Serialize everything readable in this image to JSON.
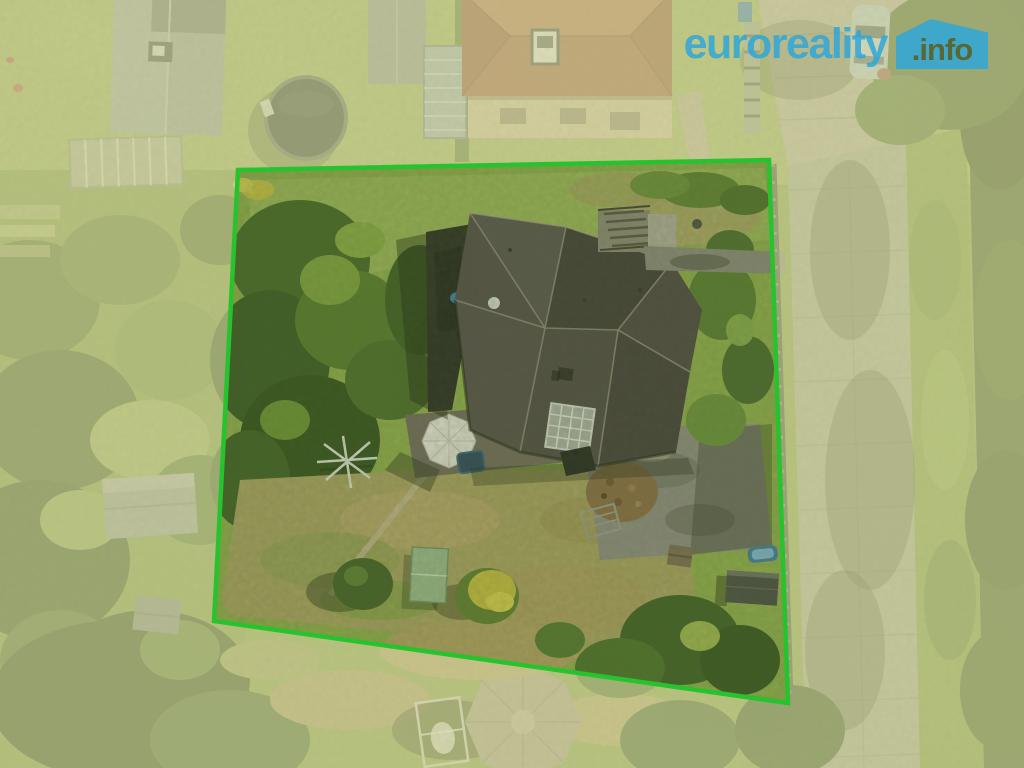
{
  "watermark": {
    "brand": "euroreality",
    "suffix": ".info"
  },
  "colors": {
    "brand_blue": "#2fa7d9",
    "suffix_olive": "#4e5c2a",
    "boundary_green": "#27c32f",
    "outside_tint": "rgba(238,233,183,0.52)"
  },
  "boundary": {
    "points": "238,170 769,160 788,703 214,621",
    "stroke_width": "4.5",
    "overlay_path": "M0,0 H1024 V768 H0 Z M238,170 L769,160 L788,703 L214,621 Z"
  },
  "scene": {
    "description": "Aerial drone photo of a residential plot outlined in green, house with dark hip roof in the middle, gardens around, street with sidewalk on the right"
  }
}
